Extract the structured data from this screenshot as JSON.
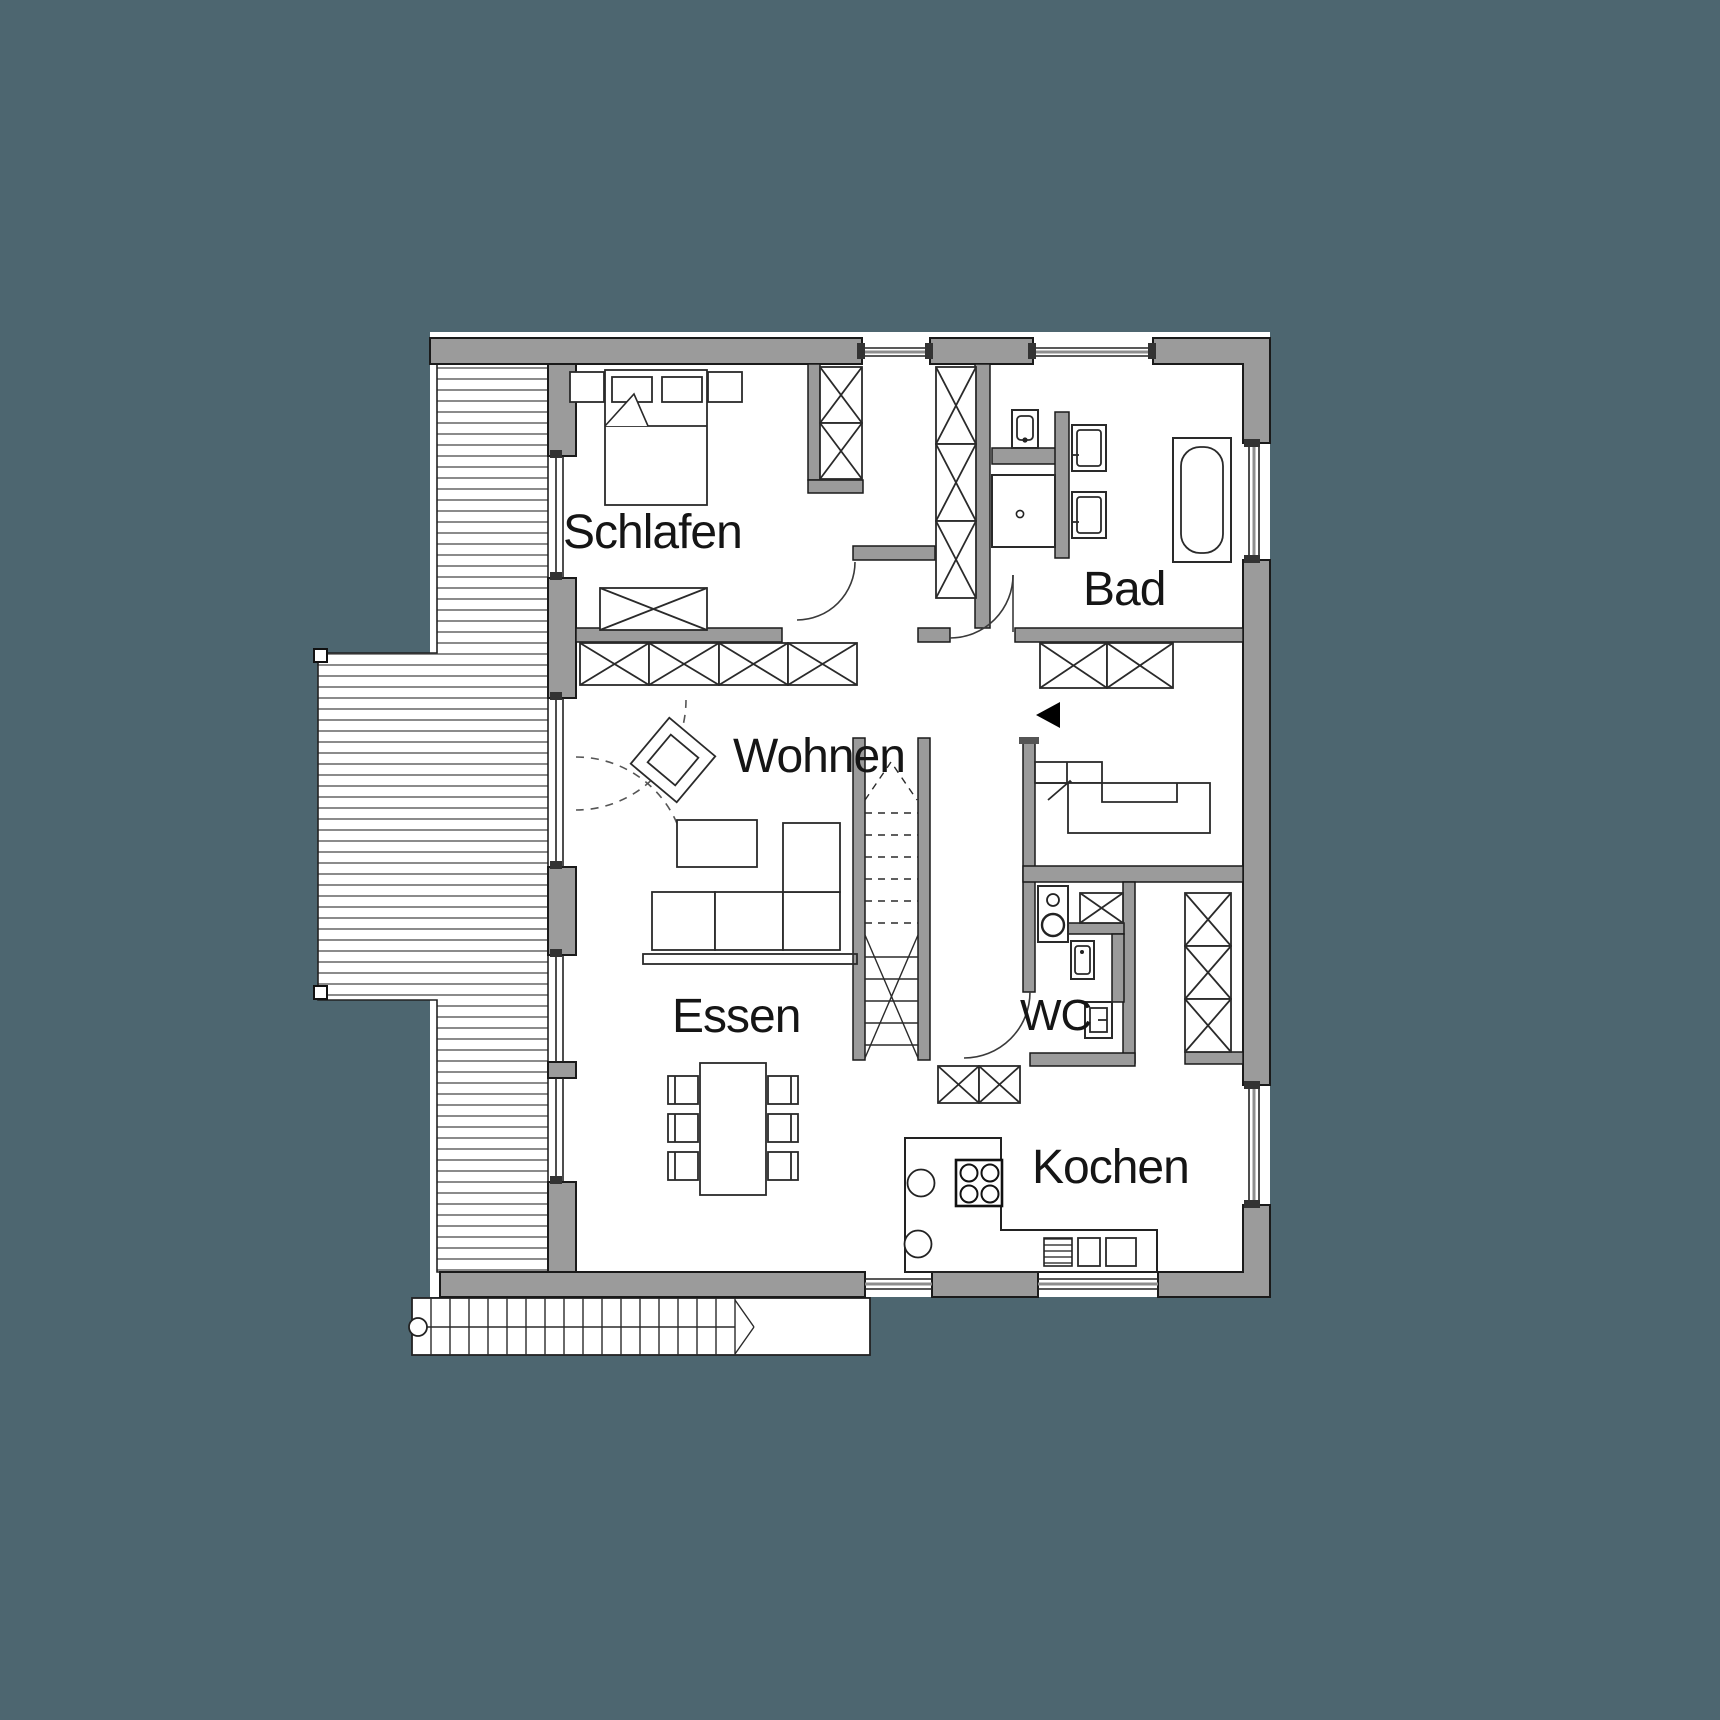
{
  "page": {
    "title": "Grundriss Obergeschoss",
    "type": "architectural-floor-plan"
  },
  "palette": {
    "background": "#4D6670",
    "wall_fill": "#9B9B9B",
    "outline": "#1A1A1A",
    "floor": "#FFFFFF"
  },
  "rooms": [
    {
      "id": "schlafen",
      "label": "Schlafen",
      "x": 563,
      "y": 548,
      "size": 48
    },
    {
      "id": "bad",
      "label": "Bad",
      "x": 1083,
      "y": 605,
      "size": 48
    },
    {
      "id": "wohnen",
      "label": "Wohnen",
      "x": 733,
      "y": 772,
      "size": 48
    },
    {
      "id": "essen",
      "label": "Essen",
      "x": 672,
      "y": 1032,
      "size": 48
    },
    {
      "id": "wc",
      "label": "WC",
      "x": 1020,
      "y": 1030,
      "size": 44
    },
    {
      "id": "kochen",
      "label": "Kochen",
      "x": 1032,
      "y": 1183,
      "size": 48
    }
  ],
  "markers": {
    "entrance_arrow": {
      "meaning": "entrance-direction",
      "points_to": "left"
    }
  },
  "furniture": [
    "double-bed",
    "nightstands",
    "wardrobe-closets",
    "dressing-closets",
    "sideboard",
    "shower",
    "toilet",
    "double-washbasins",
    "bathtub",
    "armchair",
    "coffee-table",
    "corner-sofa",
    "shelf-wall",
    "interior-staircase",
    "hall-wardrobe",
    "built-in-bench",
    "washing-machine",
    "wc-washbasin",
    "wc-toilet",
    "kitchen-counter",
    "cooktop",
    "kitchen-sinks",
    "dishwasher",
    "tall-kitchen-cabinets",
    "dining-table",
    "dining-chairs",
    "terrace-deck",
    "exterior-stairs"
  ]
}
